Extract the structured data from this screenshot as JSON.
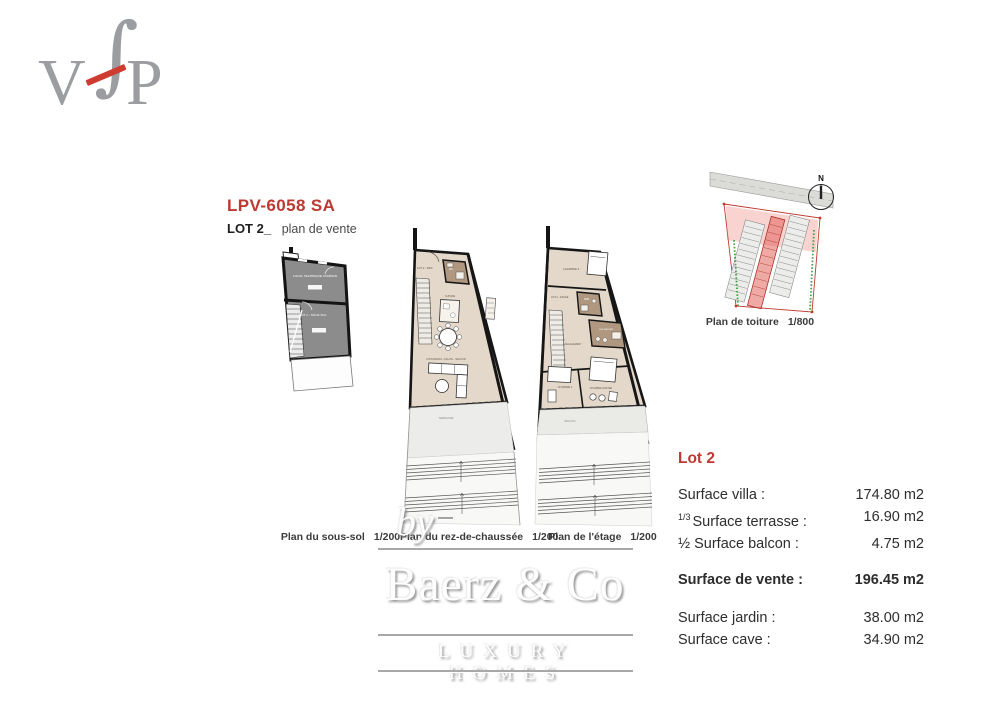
{
  "logo": {
    "v": "V",
    "f": "∫",
    "p": "P",
    "letter_color": "#9b9da0",
    "slash_color": "#ce3b30"
  },
  "header": {
    "reference": "LPV-6058 SA",
    "lot": "LOT 2_",
    "subtitle": "plan de vente"
  },
  "plans": {
    "sous_sol": {
      "caption": "Plan du sous-sol",
      "scale": "1/200",
      "rooms": {
        "technical": "LOCAL TECHNIQUE COMMUN",
        "cellar": "LOT 2 - SOUS SOL"
      }
    },
    "rdc": {
      "caption": "Plan du rez-de-chaussée",
      "scale": "1/200",
      "rooms": {
        "unit": "LOT 2 - RDC",
        "wc": "WC",
        "kitchen": "CUISINE",
        "living": "COIN REPAS / SALON - SEJOUR",
        "terrace": "TERRASSE"
      }
    },
    "etage": {
      "caption": "Plan de l'étage",
      "scale": "1/200",
      "rooms": {
        "unit": "LOT 2 - ETAGE",
        "bedroom3": "CHAMBRE 3",
        "bathroom": "SDB",
        "bathroom_master": "SDB MASTER",
        "hall": "DEGAGEMENT",
        "bedroom2": "CHAMBRE 2",
        "master": "CHAMBRE MASTER",
        "balcony": "BALCON"
      }
    },
    "roof": {
      "caption": "Plan de toiture",
      "scale": "1/800",
      "north": "N"
    }
  },
  "surfaces": {
    "title": "Lot 2",
    "accent_color": "#bc3a31",
    "rows": [
      {
        "label": "Surface villa :",
        "value": "174.80 m2"
      },
      {
        "prefix": "1/3",
        "label": "Surface terrasse :",
        "value": "16.90 m2"
      },
      {
        "label": "½ Surface balcon :",
        "value": "4.75 m2"
      }
    ],
    "total": {
      "label": "Surface de vente :",
      "value": "196.45 m2"
    },
    "extra": [
      {
        "label": "Surface jardin :",
        "value": "38.00 m2"
      },
      {
        "label": "Surface cave :",
        "value": "34.90 m2"
      }
    ]
  },
  "watermark": {
    "by": "by",
    "name": "Baerz & Co",
    "tagline": "LUXURY HOMES"
  }
}
